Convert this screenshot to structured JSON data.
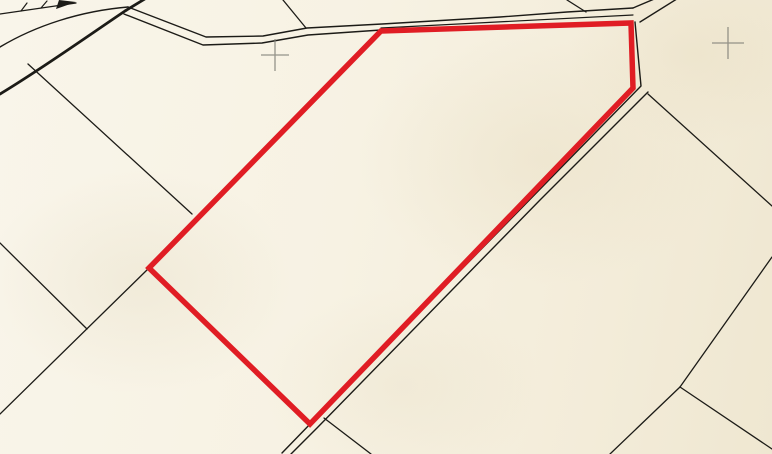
{
  "map": {
    "width": 772,
    "height": 454,
    "colors": {
      "paper": "#f7f2e3",
      "ink": "#1c1b17",
      "highlight": "#e01d24",
      "survey_cross": "#84837a"
    },
    "highlight_parcel": {
      "name": "selected-parcel-outline",
      "points": "381,31 631,23 633,88 310,424 149,268",
      "stroke_width": 5.5
    },
    "survey_crosses": [
      {
        "name": "survey-grid-cross",
        "x": 275,
        "y": 55,
        "arm_h": 14,
        "arm_v": 16
      },
      {
        "name": "survey-grid-cross",
        "x": 728,
        "y": 43,
        "arm_h": 16,
        "arm_v": 16
      }
    ],
    "filled_marks": [
      {
        "name": "path-symbol-arrowhead",
        "points": "56,9 76,2 59,0"
      }
    ],
    "paths": [
      {
        "name": "road-curve-thick-edge",
        "d": "M0,94 C40,70 85,38 125,11 L148,-3",
        "width": 2.8
      },
      {
        "name": "road-curve-north-edge",
        "d": "M0,47 C35,26 80,11 128,7",
        "width": 1.4
      },
      {
        "name": "road-north-edge",
        "d": "M128,7 L206,37 L263,36 L307,28 L382,24 L500,17 L567,12 L633,8",
        "width": 1.4
      },
      {
        "name": "road-south-edge-west",
        "d": "M124,14 L203,45 L262,43 L308,35 L381,30",
        "width": 1.4
      },
      {
        "name": "road-south-edge-east",
        "d": "M381,28 L633,15",
        "width": 1.2
      },
      {
        "name": "boundary-top-center",
        "d": "M283,0 L306,28",
        "width": 1.3
      },
      {
        "name": "boundary-top-right",
        "d": "M567,0 L586,12",
        "width": 1.3
      },
      {
        "name": "road-branch-ne-west-edge",
        "d": "M633,8 L659,-3",
        "width": 1.4
      },
      {
        "name": "road-branch-ne-east-edge",
        "d": "M640,22 L680,-3",
        "width": 1.4
      },
      {
        "name": "road-inner-edge-southeast",
        "d": "M635,22 L641,86 L314,420 L282,453",
        "width": 1.4
      },
      {
        "name": "road-outer-edge-southeast",
        "d": "M648,92 L540,200 L317,428 L291,454",
        "width": 1.4
      },
      {
        "name": "boundary-east-upper",
        "d": "M648,94 L772,206",
        "width": 1.3
      },
      {
        "name": "boundary-east-lower",
        "d": "M772,257 L680,387",
        "width": 1.3
      },
      {
        "name": "boundary-bottom-right-left-leg",
        "d": "M680,387 L610,454",
        "width": 1.3
      },
      {
        "name": "boundary-bottom-right-right-leg",
        "d": "M680,387 L772,449",
        "width": 1.3
      },
      {
        "name": "boundary-bottom-center",
        "d": "M324,418 L371,454",
        "width": 1.3
      },
      {
        "name": "boundary-northwest",
        "d": "M28,64 L192,214",
        "width": 1.3
      },
      {
        "name": "boundary-west-upper",
        "d": "M0,243 L87,329",
        "width": 1.3
      },
      {
        "name": "boundary-west-lower",
        "d": "M149,268 L0,414",
        "width": 1.3
      },
      {
        "name": "parcel-edge-under-red-southwest",
        "d": "M149,268 L310,425",
        "width": 1.3
      },
      {
        "name": "parcel-edge-under-red-northwest",
        "d": "M149,268 L381,31",
        "width": 1.1
      },
      {
        "name": "path-symbol-line",
        "d": "M0,14 L76,3",
        "width": 1.3
      },
      {
        "name": "path-symbol-tick-1",
        "d": "M21,11 L27,3",
        "width": 1.2
      },
      {
        "name": "path-symbol-tick-2",
        "d": "M41,8 L47,1",
        "width": 1.2
      }
    ]
  }
}
